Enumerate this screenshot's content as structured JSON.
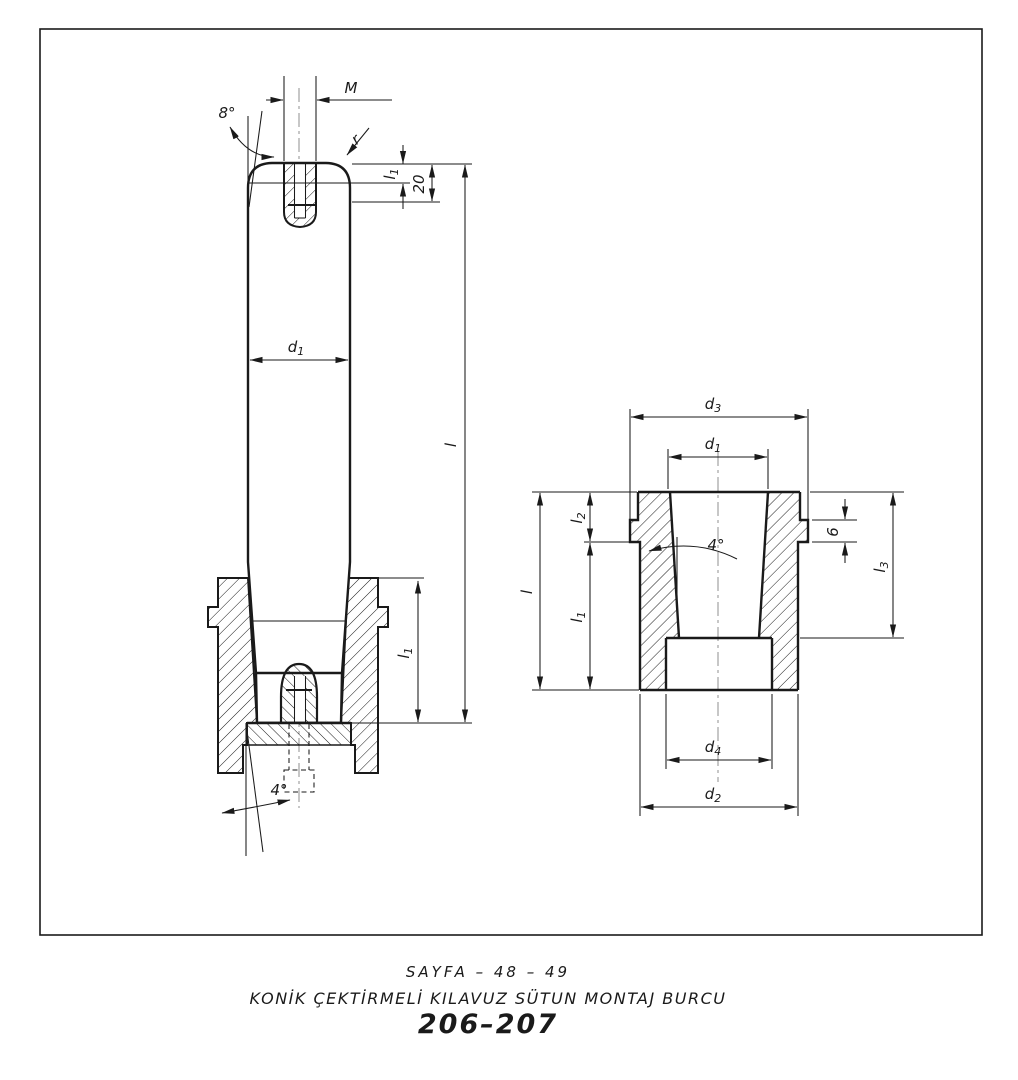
{
  "colors": {
    "line": "#1a1a1a",
    "background": "#ffffff",
    "centerline": "#8f8f8f"
  },
  "captions": {
    "page": "SAYFA – 48 – 49",
    "title": "KONİK ÇEKTİRMELİ KILAVUZ SÜTUN MONTAJ BURCU",
    "code": "206–207"
  },
  "left_view": {
    "labels": {
      "thread": "M",
      "angle_top": "8°",
      "radius": "r",
      "d1": {
        "main": "d",
        "sub": "1"
      },
      "l1_top": {
        "main": "l",
        "sub": "1"
      },
      "depth_20": "20",
      "length_l": "l",
      "l1_bottom": {
        "main": "l",
        "sub": "1"
      },
      "angle_bottom": "4°"
    }
  },
  "right_view": {
    "labels": {
      "d3": {
        "main": "d",
        "sub": "3"
      },
      "d1": {
        "main": "d",
        "sub": "1"
      },
      "l2": {
        "main": "l",
        "sub": "2"
      },
      "length_l": "l",
      "l1": {
        "main": "l",
        "sub": "1"
      },
      "lip_6": "6",
      "l3": {
        "main": "l",
        "sub": "3"
      },
      "angle": "4°",
      "d4": {
        "main": "d",
        "sub": "4"
      },
      "d2": {
        "main": "d",
        "sub": "2"
      }
    }
  }
}
